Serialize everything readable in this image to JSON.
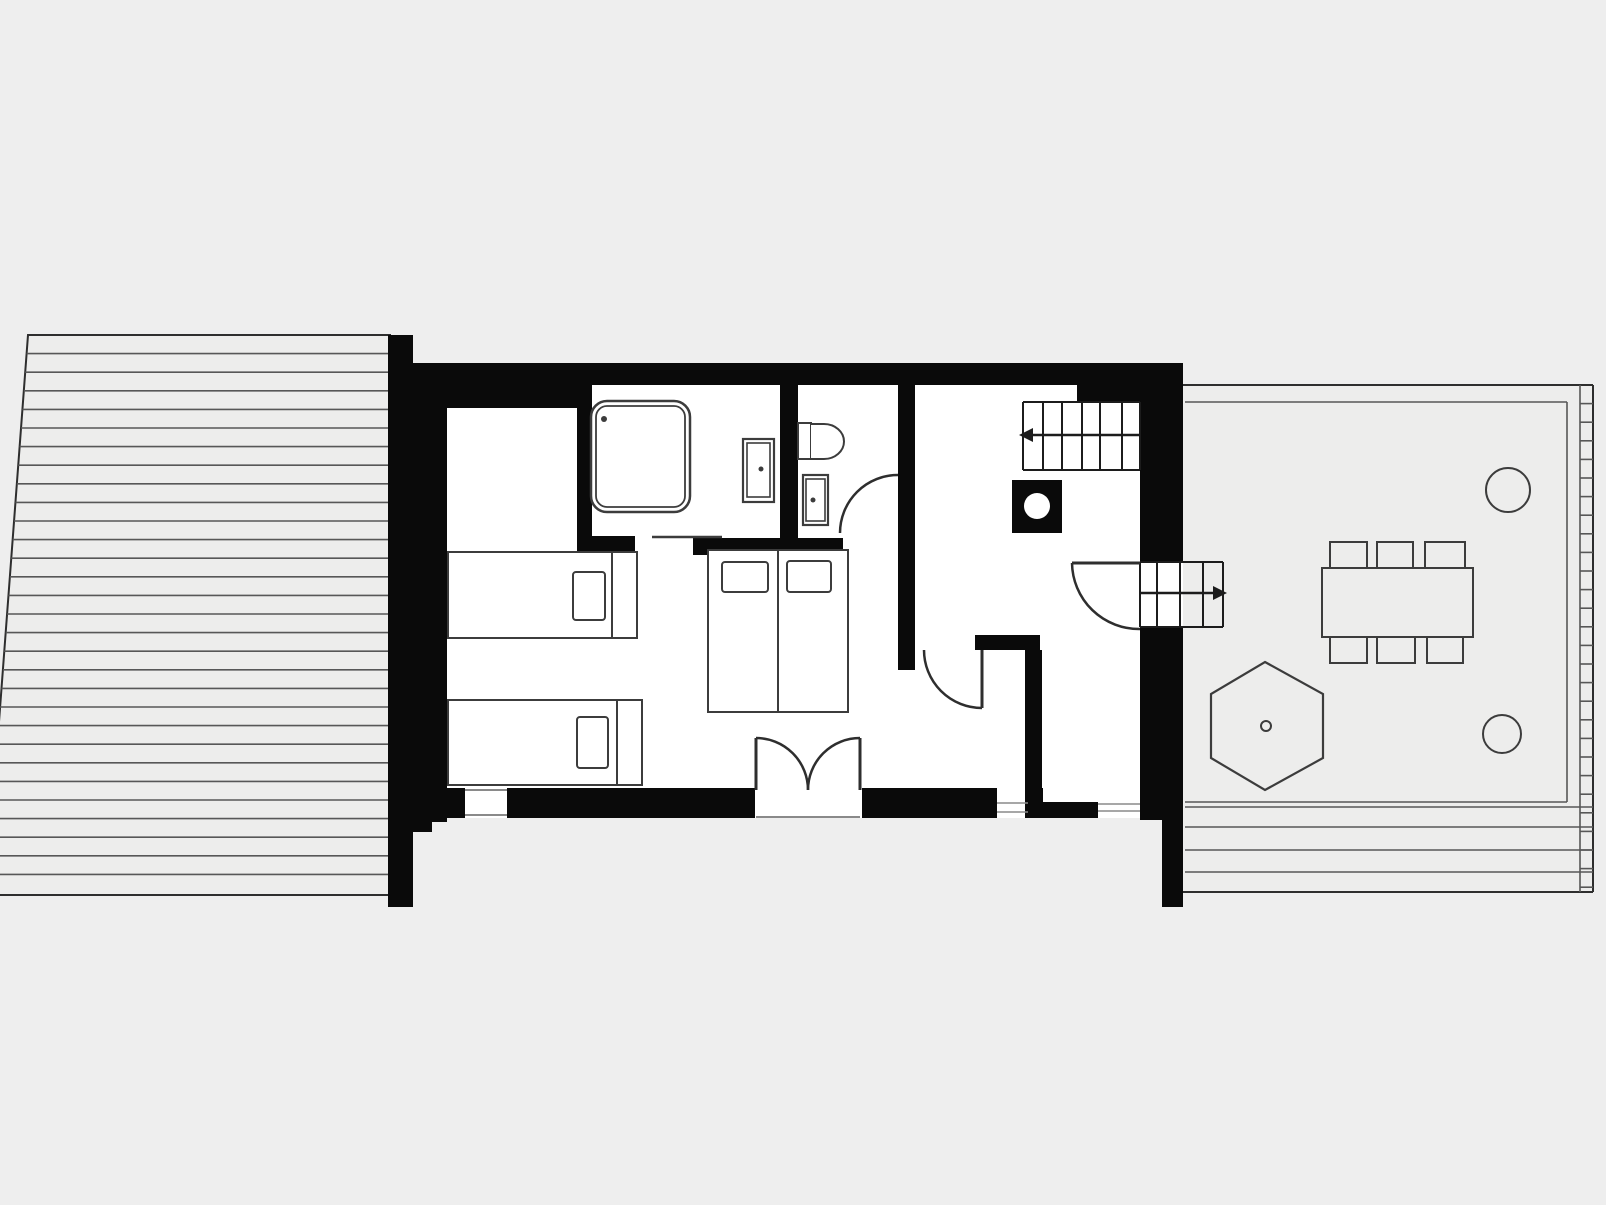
{
  "meta": {
    "canvas": {
      "w": 1606,
      "h": 1205
    }
  },
  "palette": {
    "bg": "#eeeeee",
    "wall": "#0a0a0a",
    "white": "#ffffff",
    "deck": "#ededec",
    "deckline": "#575757",
    "border": "#2e2e2e",
    "furn": "#3c3c3c",
    "stair": "#1c1c1c",
    "thin": "#8a8a8a"
  },
  "shapes": [
    {
      "name": "left-deck-clip",
      "t": "clip",
      "id": "deckL",
      "pts": "28,335 390,335 390,895 -14,895"
    },
    {
      "name": "left-deck",
      "t": "polygon",
      "pts": "28,335 390,335 390,895 -14,895",
      "fill": "$deck",
      "stroke": "$border",
      "sw": 2
    },
    {
      "name": "left-deck-planks",
      "t": "hlines",
      "ys": [
        353.6,
        372.2,
        390.8,
        409.4,
        428,
        446.6,
        465.2,
        483.8,
        502.4,
        521,
        539.6,
        558.2,
        576.8,
        595.4,
        614,
        632.6,
        651.2,
        669.8,
        688.4,
        707,
        725.6,
        744.2,
        762.8,
        781.4,
        800,
        818.6,
        837.2,
        855.8,
        874.4
      ],
      "x1": -14,
      "x2": 390,
      "stroke": "$deckline",
      "sw": 1.6,
      "clip": "deckL"
    },
    {
      "name": "right-deck",
      "t": "polygon",
      "pts": "1162,385 1593,385 1593,892 1162,892",
      "fill": "$deck",
      "stroke": "none",
      "sw": 0
    },
    {
      "name": "right-deck-top-edge",
      "t": "line",
      "x1": 1183,
      "y1": 385,
      "x2": 1593,
      "y2": 385,
      "stroke": "$border",
      "sw": 2
    },
    {
      "name": "right-deck-right-edge",
      "t": "line",
      "x1": 1593,
      "y1": 385,
      "x2": 1593,
      "y2": 892,
      "stroke": "$border",
      "sw": 2
    },
    {
      "name": "right-deck-bottom-edge",
      "t": "line",
      "x1": 1162,
      "y1": 892,
      "x2": 1593,
      "y2": 892,
      "stroke": "$border",
      "sw": 2
    },
    {
      "name": "right-deck-inner-top",
      "t": "line",
      "x1": 1185,
      "y1": 402,
      "x2": 1567,
      "y2": 402,
      "stroke": "$deckline",
      "sw": 1.6
    },
    {
      "name": "right-deck-inner-right",
      "t": "line",
      "x1": 1567,
      "y1": 402,
      "x2": 1567,
      "y2": 802,
      "stroke": "$deckline",
      "sw": 1.6
    },
    {
      "name": "right-deck-inner-bottom",
      "t": "line",
      "x1": 1185,
      "y1": 802,
      "x2": 1567,
      "y2": 802,
      "stroke": "$deckline",
      "sw": 1.6
    },
    {
      "name": "right-deck-strip-line",
      "t": "line",
      "x1": 1580,
      "y1": 385,
      "x2": 1580,
      "y2": 892,
      "stroke": "$deckline",
      "sw": 1.6
    },
    {
      "name": "right-deck-strip-rungs",
      "t": "hlines",
      "ys": [
        403.6,
        422.2,
        440.8,
        459.4,
        478,
        496.6,
        515.2,
        533.8,
        552.4,
        571,
        589.6,
        608.2,
        626.8,
        645.4,
        664,
        682.6,
        701.2,
        719.8,
        738.4,
        757,
        775.6,
        794.2,
        812.8,
        831.4,
        850,
        868.6,
        887.2
      ],
      "x1": 1580,
      "x2": 1593,
      "stroke": "$deckline",
      "sw": 1.6
    },
    {
      "name": "right-deck-bottom-planks",
      "t": "hlines",
      "ys": [
        807,
        827,
        850,
        872
      ],
      "x1": 1185,
      "x2": 1593,
      "stroke": "$deckline",
      "sw": 1.6
    },
    {
      "name": "house-floor",
      "t": "rect",
      "x": 413,
      "y": 363,
      "w": 770,
      "h": 455,
      "fill": "$white",
      "stroke": "none",
      "sw": 0
    },
    {
      "name": "deck-junction-strip",
      "t": "rect",
      "x": 388,
      "y": 335,
      "w": 25,
      "h": 572,
      "fill": "$wall"
    },
    {
      "name": "left-wall",
      "t": "rect",
      "x": 413,
      "y": 363,
      "w": 34,
      "h": 459,
      "fill": "$wall"
    },
    {
      "name": "top-wall",
      "t": "rect",
      "x": 413,
      "y": 363,
      "w": 670,
      "h": 22,
      "fill": "$wall"
    },
    {
      "name": "top-left-wall-block",
      "t": "rect",
      "x": 413,
      "y": 383,
      "w": 164,
      "h": 25,
      "fill": "$wall"
    },
    {
      "name": "bedroom-bath-wall",
      "t": "rect",
      "x": 577,
      "y": 383,
      "w": 15,
      "h": 170,
      "fill": "$wall"
    },
    {
      "name": "bath-wall-foot",
      "t": "rect",
      "x": 577,
      "y": 536,
      "w": 58,
      "h": 17,
      "fill": "$wall"
    },
    {
      "name": "bath-divider-wall",
      "t": "rect",
      "x": 780,
      "y": 383,
      "w": 18,
      "h": 157,
      "fill": "$wall"
    },
    {
      "name": "bath-bottom-wall",
      "t": "rect",
      "x": 693,
      "y": 538,
      "w": 150,
      "h": 17,
      "fill": "$wall"
    },
    {
      "name": "hall-wall",
      "t": "rect",
      "x": 898,
      "y": 383,
      "w": 17,
      "h": 287,
      "fill": "$wall"
    },
    {
      "name": "top-step-wall",
      "t": "rect",
      "x": 1077,
      "y": 363,
      "w": 63,
      "h": 39,
      "fill": "$wall"
    },
    {
      "name": "right-wall-upper",
      "t": "rect",
      "x": 1140,
      "y": 363,
      "w": 43,
      "h": 199,
      "fill": "$wall"
    },
    {
      "name": "right-wall-lower",
      "t": "rect",
      "x": 1140,
      "y": 627,
      "w": 43,
      "h": 193,
      "fill": "$wall"
    },
    {
      "name": "right-wall-foot",
      "t": "rect",
      "x": 1162,
      "y": 820,
      "w": 21,
      "h": 87,
      "fill": "$wall"
    },
    {
      "name": "closet-top-wall",
      "t": "rect",
      "x": 975,
      "y": 635,
      "w": 65,
      "h": 15,
      "fill": "$wall"
    },
    {
      "name": "closet-right-wall",
      "t": "rect",
      "x": 1025,
      "y": 650,
      "w": 17,
      "h": 168,
      "fill": "$wall"
    },
    {
      "name": "bottom-wall-a",
      "t": "rect",
      "x": 413,
      "y": 788,
      "w": 52,
      "h": 30,
      "fill": "$wall"
    },
    {
      "name": "bottom-wall-b",
      "t": "rect",
      "x": 507,
      "y": 788,
      "w": 248,
      "h": 30,
      "fill": "$wall"
    },
    {
      "name": "bottom-wall-c",
      "t": "rect",
      "x": 862,
      "y": 788,
      "w": 135,
      "h": 30,
      "fill": "$wall"
    },
    {
      "name": "bottom-wall-d",
      "t": "rect",
      "x": 1028,
      "y": 788,
      "w": 15,
      "h": 30,
      "fill": "$wall"
    },
    {
      "name": "bottom-half-wall",
      "t": "rect",
      "x": 1043,
      "y": 802,
      "w": 55,
      "h": 16,
      "fill": "$wall"
    },
    {
      "name": "bottom-left-foot",
      "t": "rect",
      "x": 413,
      "y": 818,
      "w": 19,
      "h": 14,
      "fill": "$wall"
    },
    {
      "name": "window-1-outer-line",
      "t": "line",
      "x1": 465,
      "y1": 790,
      "x2": 507,
      "y2": 790,
      "stroke": "$thin",
      "sw": 2
    },
    {
      "name": "window-1-inner-line",
      "t": "line",
      "x1": 465,
      "y1": 815,
      "x2": 507,
      "y2": 815,
      "stroke": "$thin",
      "sw": 2
    },
    {
      "name": "window-2-outer-line",
      "t": "line",
      "x1": 997,
      "y1": 803,
      "x2": 1028,
      "y2": 803,
      "stroke": "$thin",
      "sw": 1.5
    },
    {
      "name": "window-2-inner-line",
      "t": "line",
      "x1": 997,
      "y1": 812,
      "x2": 1028,
      "y2": 812,
      "stroke": "$thin",
      "sw": 1.5
    },
    {
      "name": "window-3-outer-line",
      "t": "line",
      "x1": 1098,
      "y1": 804,
      "x2": 1140,
      "y2": 804,
      "stroke": "$thin",
      "sw": 1.5
    },
    {
      "name": "window-3-inner-line",
      "t": "line",
      "x1": 1098,
      "y1": 811,
      "x2": 1140,
      "y2": 811,
      "stroke": "$thin",
      "sw": 1.5
    },
    {
      "name": "entrance-threshold-line",
      "t": "line",
      "x1": 756,
      "y1": 817,
      "x2": 860,
      "y2": 817,
      "stroke": "$thin",
      "sw": 2
    },
    {
      "name": "interior-stairs-treads",
      "t": "vlines",
      "xs": [
        1023,
        1043,
        1062,
        1082,
        1100,
        1122,
        1140
      ],
      "y1": 402,
      "y2": 470,
      "stroke": "$stair",
      "sw": 2
    },
    {
      "name": "interior-stairs-top-line",
      "t": "line",
      "x1": 1023,
      "y1": 402,
      "x2": 1140,
      "y2": 402,
      "stroke": "$stair",
      "sw": 2
    },
    {
      "name": "interior-stairs-bottom-line",
      "t": "line",
      "x1": 1023,
      "y1": 470,
      "x2": 1140,
      "y2": 470,
      "stroke": "$stair",
      "sw": 2
    },
    {
      "name": "interior-stairs-direction-line",
      "t": "line",
      "x1": 1023,
      "y1": 435,
      "x2": 1140,
      "y2": 435,
      "stroke": "$stair",
      "sw": 2.5
    },
    {
      "name": "interior-stairs-arrow",
      "t": "polygon",
      "pts": "1019,435 1033,428 1033,442",
      "fill": "$stair",
      "stroke": "none",
      "sw": 0
    },
    {
      "name": "exterior-stairs-treads",
      "t": "vlines",
      "xs": [
        1140,
        1157,
        1180,
        1203,
        1223
      ],
      "y1": 562,
      "y2": 627,
      "stroke": "$stair",
      "sw": 2
    },
    {
      "name": "exterior-stairs-top-line",
      "t": "line",
      "x1": 1140,
      "y1": 562,
      "x2": 1223,
      "y2": 562,
      "stroke": "$stair",
      "sw": 2
    },
    {
      "name": "exterior-stairs-bottom-line",
      "t": "line",
      "x1": 1140,
      "y1": 627,
      "x2": 1223,
      "y2": 627,
      "stroke": "$stair",
      "sw": 2
    },
    {
      "name": "exterior-stairs-direction-line",
      "t": "line",
      "x1": 1140,
      "y1": 593,
      "x2": 1219,
      "y2": 593,
      "stroke": "$stair",
      "sw": 2.5
    },
    {
      "name": "exterior-stairs-arrow",
      "t": "polygon",
      "pts": "1227,593 1213,586 1213,600",
      "fill": "$stair",
      "stroke": "none",
      "sw": 0
    },
    {
      "name": "entrance-door-left-leaf",
      "t": "line",
      "x1": 756,
      "y1": 738,
      "x2": 756,
      "y2": 790,
      "stroke": "$border",
      "sw": 3
    },
    {
      "name": "entrance-door-left-arc",
      "t": "path",
      "d": "M 756 738 A 52 52 0 0 1 808 790",
      "stroke": "$border",
      "sw": 2.5,
      "fill": "none"
    },
    {
      "name": "entrance-door-right-leaf",
      "t": "line",
      "x1": 860,
      "y1": 738,
      "x2": 860,
      "y2": 790,
      "stroke": "$border",
      "sw": 3
    },
    {
      "name": "entrance-door-right-arc",
      "t": "path",
      "d": "M 860 738 A 52 52 0 0 0 808 790",
      "stroke": "$border",
      "sw": 2.5,
      "fill": "none"
    },
    {
      "name": "bathroom-door-arc",
      "t": "path",
      "d": "M 840 533 A 58 58 0 0 1 898 475",
      "stroke": "$border",
      "sw": 2.5,
      "fill": "none"
    },
    {
      "name": "bathroom-slider-door-line",
      "t": "line",
      "x1": 652,
      "y1": 537,
      "x2": 722,
      "y2": 537,
      "stroke": "$furn",
      "sw": 2.5
    },
    {
      "name": "closet-door-leaf",
      "t": "line",
      "x1": 982,
      "y1": 650,
      "x2": 982,
      "y2": 708,
      "stroke": "$border",
      "sw": 3
    },
    {
      "name": "closet-door-arc",
      "t": "path",
      "d": "M 924 650 A 58 58 0 0 0 982 708",
      "stroke": "$border",
      "sw": 2.5,
      "fill": "none"
    },
    {
      "name": "side-door-leaf",
      "t": "line",
      "x1": 1072,
      "y1": 563,
      "x2": 1140,
      "y2": 563,
      "stroke": "$border",
      "sw": 3
    },
    {
      "name": "side-door-arc",
      "t": "path",
      "d": "M 1072 563 A 67 67 0 0 0 1140 629",
      "stroke": "$border",
      "sw": 2.5,
      "fill": "none"
    },
    {
      "name": "shower-tray-outer",
      "t": "rect",
      "x": 591,
      "y": 401,
      "w": 99,
      "h": 111,
      "rx": 16,
      "fill": "$white",
      "stroke": "$furn",
      "sw": 2.5
    },
    {
      "name": "shower-tray-inner",
      "t": "rect",
      "x": 596,
      "y": 406,
      "w": 89,
      "h": 101,
      "rx": 11,
      "fill": "none",
      "stroke": "$furn",
      "sw": 1.8
    },
    {
      "name": "shower-drain-dot",
      "t": "circle",
      "cx": 604,
      "cy": 419,
      "r": 3,
      "fill": "$furn",
      "stroke": "none",
      "sw": 0
    },
    {
      "name": "sink-1-outer",
      "t": "rect",
      "x": 743,
      "y": 439,
      "w": 31,
      "h": 63,
      "fill": "$white",
      "stroke": "$furn",
      "sw": 2.2
    },
    {
      "name": "sink-1-inner",
      "t": "rect",
      "x": 747,
      "y": 443,
      "w": 23,
      "h": 54,
      "fill": "none",
      "stroke": "$furn",
      "sw": 1.6
    },
    {
      "name": "sink-1-faucet-dot",
      "t": "circle",
      "cx": 761,
      "cy": 469,
      "r": 2.5,
      "fill": "$furn",
      "stroke": "none",
      "sw": 0
    },
    {
      "name": "toilet-cistern",
      "t": "rect",
      "x": 798,
      "y": 423,
      "w": 13,
      "h": 36,
      "fill": "$white",
      "stroke": "$furn",
      "sw": 2
    },
    {
      "name": "toilet-bowl",
      "t": "path",
      "d": "M 811 424 L 824 424 A 20 17.5 0 0 1 824 459 L 811 459",
      "stroke": "$furn",
      "sw": 2,
      "fill": "$white"
    },
    {
      "name": "sink-2-outer",
      "t": "rect",
      "x": 803,
      "y": 475,
      "w": 25,
      "h": 50,
      "fill": "$white",
      "stroke": "$furn",
      "sw": 2.2
    },
    {
      "name": "sink-2-inner",
      "t": "rect",
      "x": 806,
      "y": 479,
      "w": 19,
      "h": 42,
      "fill": "none",
      "stroke": "$furn",
      "sw": 1.6
    },
    {
      "name": "sink-2-faucet-dot",
      "t": "circle",
      "cx": 813,
      "cy": 500,
      "r": 2.5,
      "fill": "$furn",
      "stroke": "none",
      "sw": 0
    },
    {
      "name": "single-bed-1-frame",
      "t": "rect",
      "x": 448,
      "y": 552,
      "w": 189,
      "h": 86,
      "fill": "$white",
      "stroke": "$furn",
      "sw": 2
    },
    {
      "name": "single-bed-1-head-line",
      "t": "line",
      "x1": 612,
      "y1": 552,
      "x2": 612,
      "y2": 638,
      "stroke": "$furn",
      "sw": 2
    },
    {
      "name": "single-bed-1-pillow",
      "t": "rect",
      "x": 573,
      "y": 572,
      "w": 32,
      "h": 48,
      "rx": 3,
      "fill": "$white",
      "stroke": "$furn",
      "sw": 2
    },
    {
      "name": "single-bed-2-frame",
      "t": "rect",
      "x": 448,
      "y": 700,
      "w": 194,
      "h": 85,
      "fill": "$white",
      "stroke": "$furn",
      "sw": 2
    },
    {
      "name": "single-bed-2-head-line",
      "t": "line",
      "x1": 617,
      "y1": 700,
      "x2": 617,
      "y2": 785,
      "stroke": "$furn",
      "sw": 2
    },
    {
      "name": "single-bed-2-pillow",
      "t": "rect",
      "x": 577,
      "y": 717,
      "w": 31,
      "h": 51,
      "rx": 3,
      "fill": "$white",
      "stroke": "$furn",
      "sw": 2
    },
    {
      "name": "double-bed-frame",
      "t": "rect",
      "x": 708,
      "y": 550,
      "w": 140,
      "h": 162,
      "fill": "$white",
      "stroke": "$furn",
      "sw": 2
    },
    {
      "name": "double-bed-center-line",
      "t": "line",
      "x1": 778,
      "y1": 550,
      "x2": 778,
      "y2": 712,
      "stroke": "$furn",
      "sw": 2
    },
    {
      "name": "double-bed-pillow-left",
      "t": "rect",
      "x": 722,
      "y": 562,
      "w": 46,
      "h": 30,
      "rx": 3,
      "fill": "$white",
      "stroke": "$furn",
      "sw": 2
    },
    {
      "name": "double-bed-pillow-right",
      "t": "rect",
      "x": 787,
      "y": 561,
      "w": 44,
      "h": 31,
      "rx": 3,
      "fill": "$white",
      "stroke": "$furn",
      "sw": 2
    },
    {
      "name": "stove-body",
      "t": "rect",
      "x": 1012,
      "y": 480,
      "w": 50,
      "h": 53,
      "fill": "$wall",
      "stroke": "none",
      "sw": 0
    },
    {
      "name": "stove-flue-circle",
      "t": "circle",
      "cx": 1037,
      "cy": 506,
      "r": 13,
      "fill": "$white",
      "stroke": "none",
      "sw": 0
    },
    {
      "name": "dining-table",
      "t": "rect",
      "x": 1322,
      "y": 568,
      "w": 151,
      "h": 69,
      "fill": "$deck",
      "stroke": "$furn",
      "sw": 2
    },
    {
      "name": "chair-top-1",
      "t": "rect",
      "x": 1330,
      "y": 542,
      "w": 37,
      "h": 26,
      "fill": "$deck",
      "stroke": "$furn",
      "sw": 2
    },
    {
      "name": "chair-top-2",
      "t": "rect",
      "x": 1377,
      "y": 542,
      "w": 36,
      "h": 26,
      "fill": "$deck",
      "stroke": "$furn",
      "sw": 2
    },
    {
      "name": "chair-top-3",
      "t": "rect",
      "x": 1425,
      "y": 542,
      "w": 40,
      "h": 26,
      "fill": "$deck",
      "stroke": "$furn",
      "sw": 2
    },
    {
      "name": "chair-bottom-1",
      "t": "rect",
      "x": 1330,
      "y": 637,
      "w": 37,
      "h": 26,
      "fill": "$deck",
      "stroke": "$furn",
      "sw": 2
    },
    {
      "name": "chair-bottom-2",
      "t": "rect",
      "x": 1377,
      "y": 637,
      "w": 38,
      "h": 26,
      "fill": "$deck",
      "stroke": "$furn",
      "sw": 2
    },
    {
      "name": "chair-bottom-3",
      "t": "rect",
      "x": 1427,
      "y": 637,
      "w": 36,
      "h": 26,
      "fill": "$deck",
      "stroke": "$furn",
      "sw": 2
    },
    {
      "name": "hexagon-feature",
      "t": "polygon",
      "pts": "1265,662 1323,694 1323,758 1265,790 1211,758 1211,694",
      "fill": "$deck",
      "stroke": "$furn",
      "sw": 2.2
    },
    {
      "name": "hexagon-center-ring",
      "t": "circle",
      "cx": 1266,
      "cy": 726,
      "r": 5,
      "fill": "none",
      "stroke": "$furn",
      "sw": 2
    },
    {
      "name": "round-feature-top",
      "t": "circle",
      "cx": 1508,
      "cy": 490,
      "r": 22,
      "fill": "$deck",
      "stroke": "$furn",
      "sw": 2
    },
    {
      "name": "round-feature-bottom",
      "t": "circle",
      "cx": 1502,
      "cy": 734,
      "r": 19,
      "fill": "$deck",
      "stroke": "$furn",
      "sw": 2
    }
  ]
}
